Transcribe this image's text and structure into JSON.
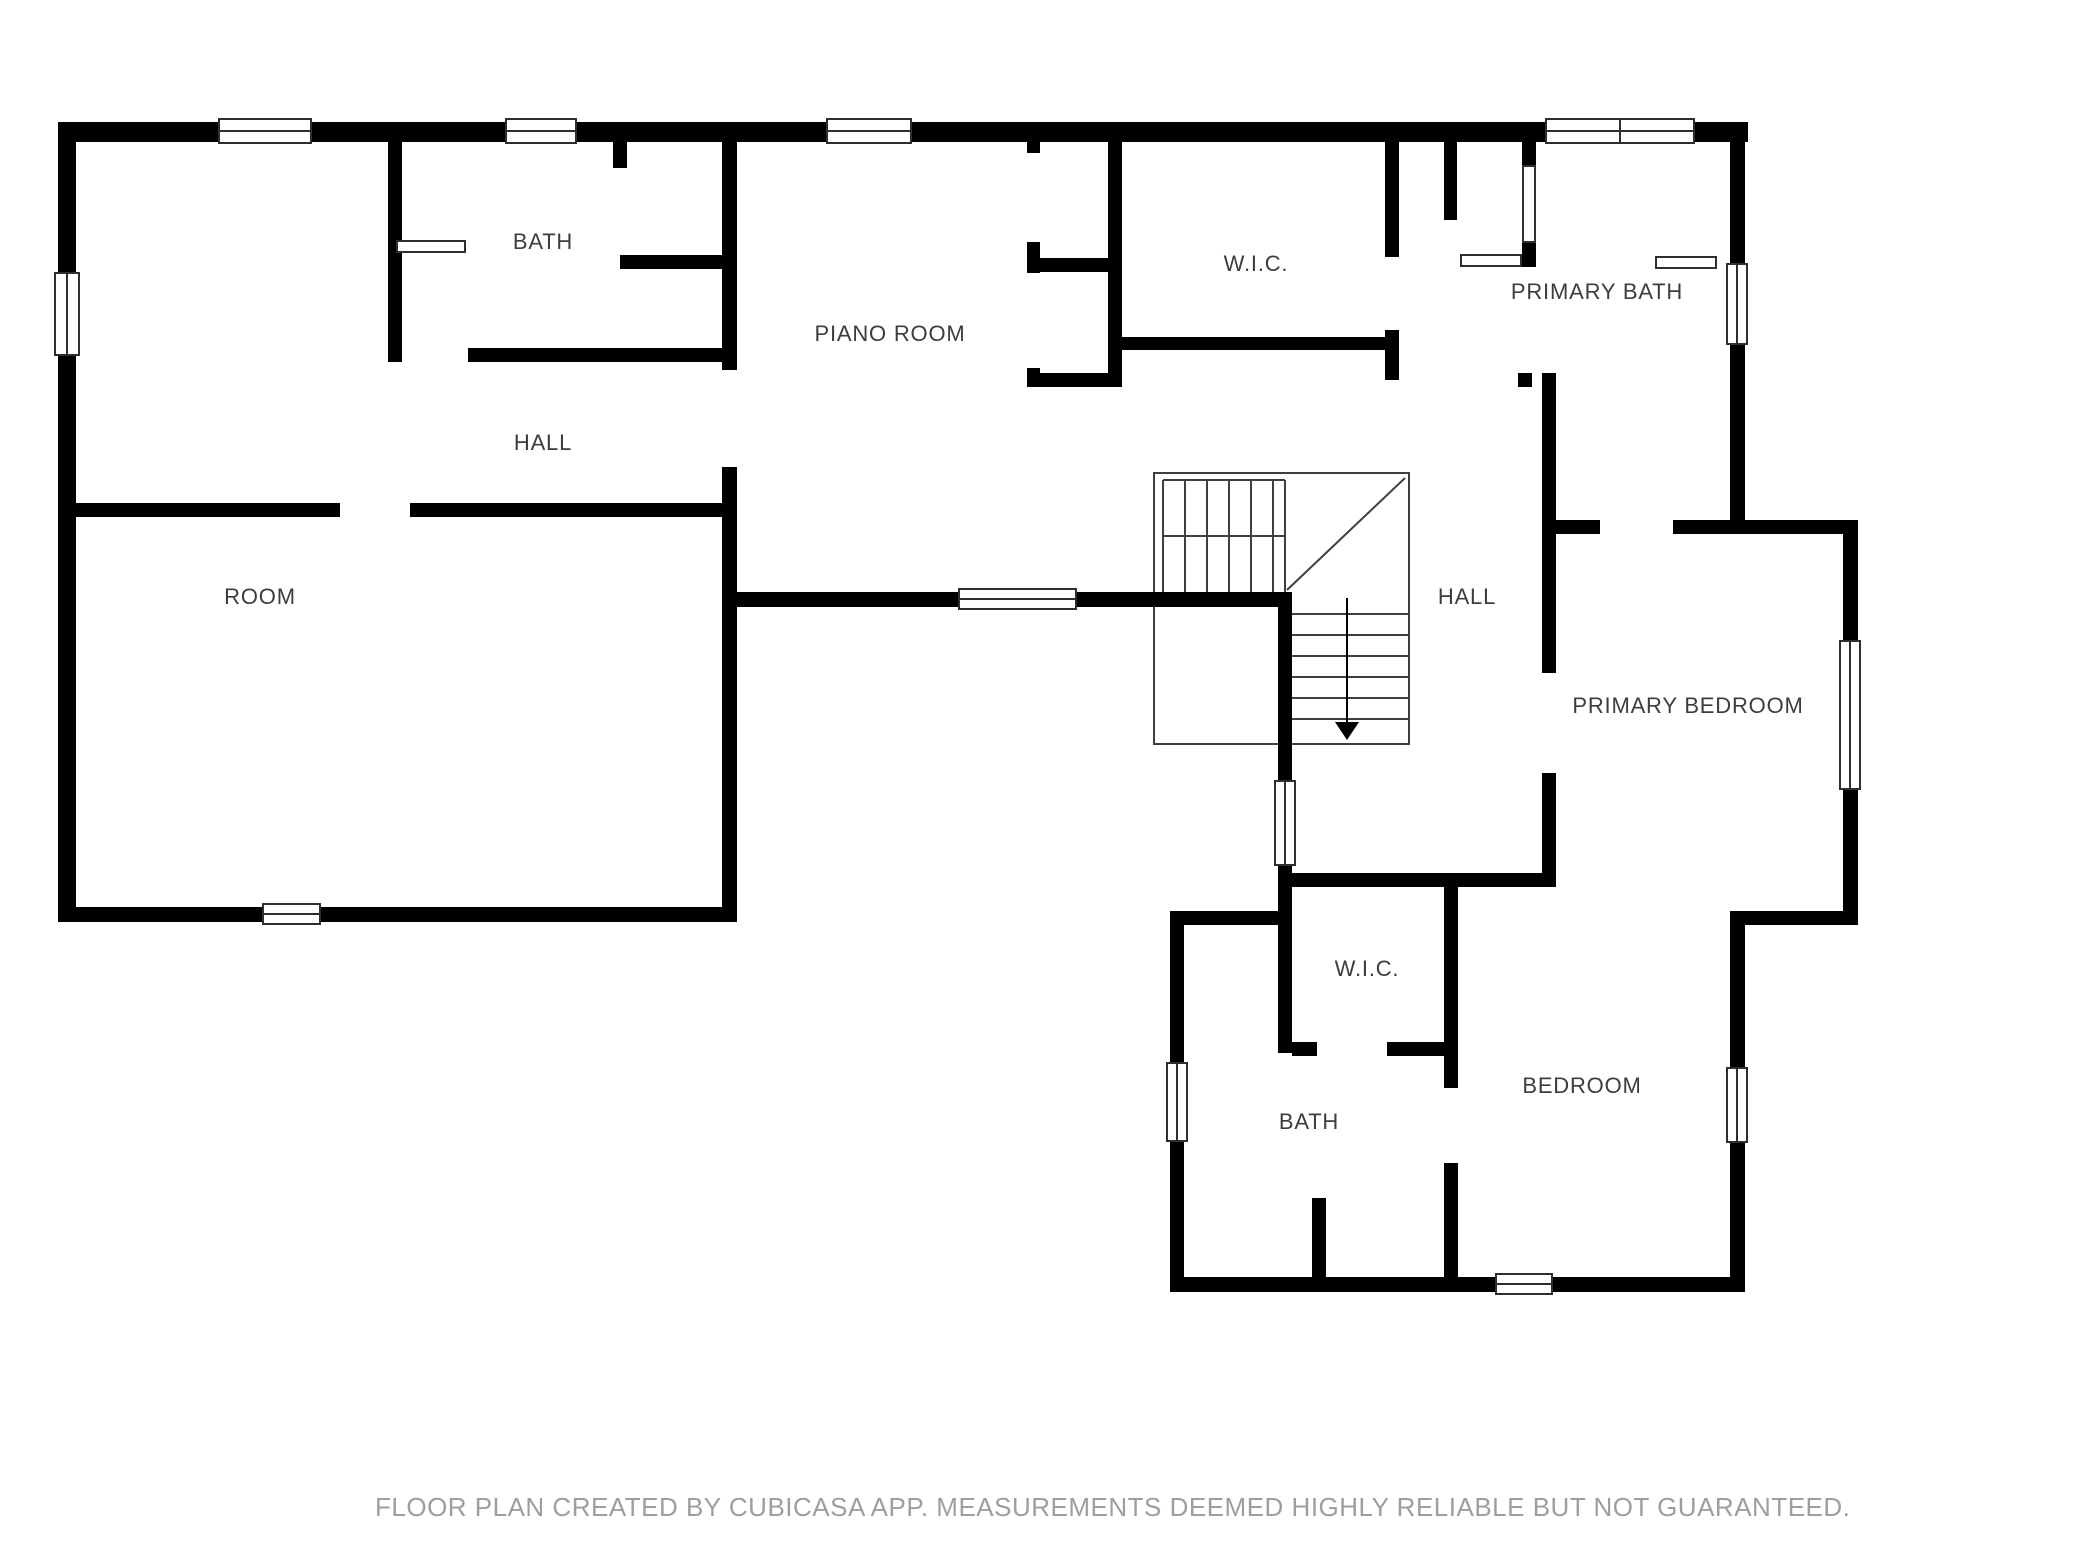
{
  "floor_plan": {
    "rooms": [
      {
        "id": "bath-upper",
        "label": "BATH"
      },
      {
        "id": "piano-room",
        "label": "PIANO ROOM"
      },
      {
        "id": "wic-upper",
        "label": "W.I.C."
      },
      {
        "id": "primary-bath",
        "label": "PRIMARY BATH"
      },
      {
        "id": "hall-left",
        "label": "HALL"
      },
      {
        "id": "hall-stairs",
        "label": "HALL"
      },
      {
        "id": "room",
        "label": "ROOM"
      },
      {
        "id": "primary-bedroom",
        "label": "PRIMARY BEDROOM"
      },
      {
        "id": "wic-lower",
        "label": "W.I.C."
      },
      {
        "id": "bath-lower",
        "label": "BATH"
      },
      {
        "id": "bedroom",
        "label": "BEDROOM"
      }
    ],
    "stairs": {
      "arrow_direction": "down"
    },
    "colors": {
      "wall": "#000000",
      "label": "#3d3d3d",
      "footer": "#9e9e9e",
      "background": "#ffffff"
    }
  },
  "footer": {
    "disclaimer": "FLOOR PLAN CREATED BY CUBICASA APP. MEASUREMENTS DEEMED HIGHLY RELIABLE BUT NOT GUARANTEED."
  }
}
